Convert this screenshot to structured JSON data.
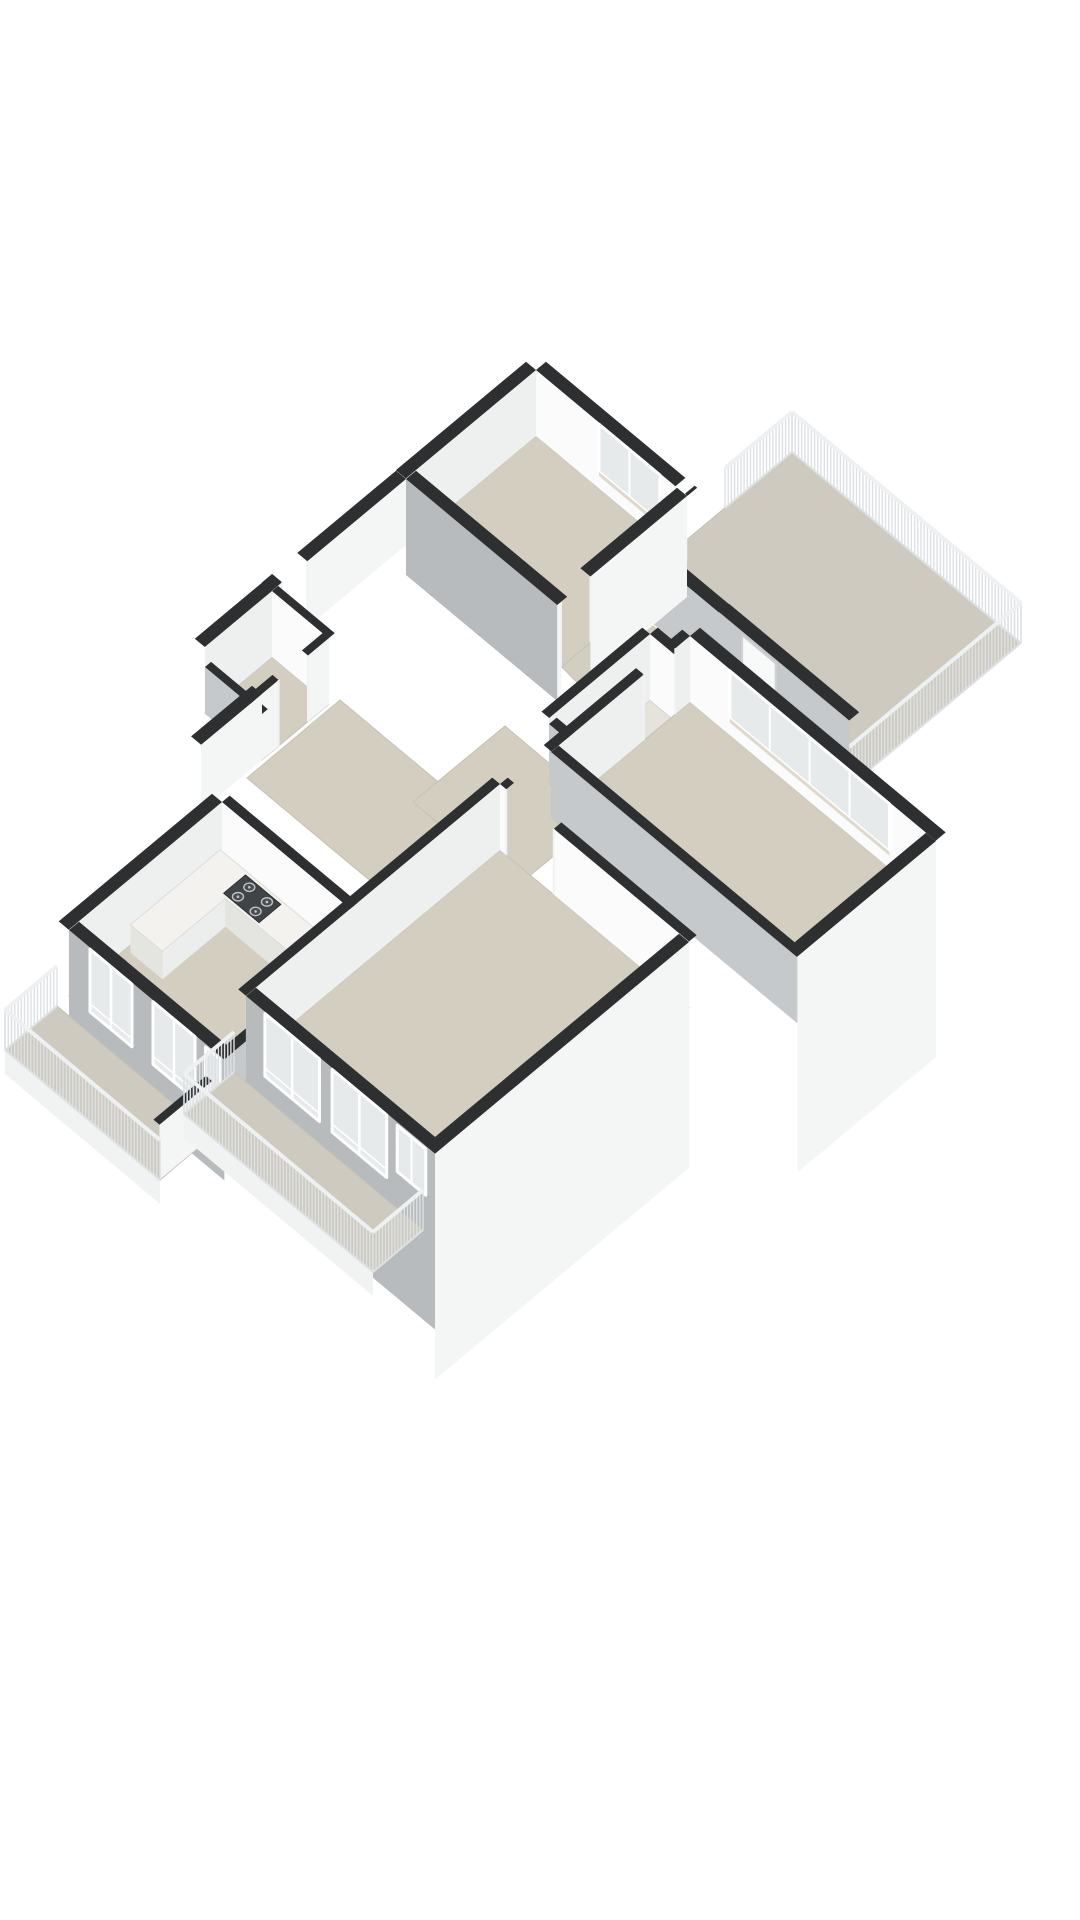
{
  "meta": {
    "title": "3D floor plan rendering",
    "background": "#ffffff",
    "render_style": "axonometric-cutaway",
    "rooms": [
      "bedroom-1",
      "bedroom-2",
      "living-room",
      "kitchen",
      "bathroom",
      "toilet",
      "hallway",
      "entry",
      "balcony-northeast",
      "balcony-southwest-kitchen",
      "balcony-southwest-living"
    ],
    "fixtures": [
      "kitchen-counter",
      "stove",
      "kitchen-sink",
      "bathtub"
    ],
    "features": [
      "slatted-balcony-railings",
      "french-doors",
      "window-bands",
      "door-openings",
      "cut-walls-dark-tops"
    ]
  },
  "palette": {
    "top": "#2d2f31",
    "white": "#fbfbfc",
    "faceSE": "#eef0f0",
    "bright": "#f4f5f5",
    "grayExt": "#b7bbbd",
    "grayInt": "#c6c9cb",
    "floor": "#d4cec1",
    "balcony": "#cecabf",
    "bath": "#e5e3dc",
    "glass": "#e7eaeb",
    "frame": "#ffffff",
    "sill": "#ded9cc",
    "jamb": "#f2f2f2",
    "slat": "#dde1e3",
    "railTop": "#eef0f1",
    "counterTop": "#f3f2ee",
    "counterFace": "#e4e4e1",
    "counterSide": "#eceded",
    "doorLeaf": "#f8f9f9",
    "doorFrame": "#cfd2d3",
    "handle": "#9aa0a3",
    "stove": "#404447",
    "burner": "#bfc4c6",
    "tubLine": "#d6d8d7",
    "tubIn": "#eeede8",
    "skirtFront": "#f1f2f2",
    "floorLine": "#c6c1b4"
  },
  "projection": {
    "e1": [
      42,
      35
    ],
    "e2": [
      -42,
      35
    ],
    "z_px": 33,
    "wall_h": 66,
    "rail_h": 40
  },
  "scene": [
    {
      "kind": "floor",
      "name": "balcony-northeast-floor",
      "o": [
        792,
        452
      ],
      "a": 5.45,
      "b": 4.1,
      "fill": "balcony"
    },
    {
      "kind": "rail",
      "name": "balcony-ne-railing-nw",
      "s": [
        792,
        452
      ],
      "e": [
        1021,
        643
      ]
    },
    {
      "kind": "rail",
      "name": "balcony-ne-railing-se",
      "s": [
        1021,
        643
      ],
      "e": [
        849,
        787
      ]
    },
    {
      "kind": "rail",
      "name": "balcony-ne-railing-sw",
      "s": [
        849,
        787
      ],
      "e": [
        719,
        678
      ]
    },
    {
      "kind": "rail",
      "name": "balcony-ne-railing-return",
      "s": [
        792,
        452
      ],
      "e": [
        725,
        508
      ]
    },
    {
      "kind": "floorAbs",
      "name": "hall-floor",
      "pts": [
        [
          559,
          664
        ],
        [
          630,
          607
        ],
        [
          762,
          717
        ],
        [
          684,
          793
        ]
      ],
      "fill": "floor"
    },
    {
      "kind": "wall",
      "name": "hall-balcony-wall",
      "s": [
        620,
        596
      ],
      "ax": "e1",
      "len": 2.36,
      "t": 13,
      "face": "grayInt",
      "h": 66
    },
    {
      "kind": "wall",
      "name": "balcony-door-wall",
      "s": [
        719,
        678
      ],
      "ax": "e1",
      "len": 3.1,
      "t": 13,
      "face": "grayInt",
      "h": 66,
      "doors": [
        [
          0.55,
          1.35
        ]
      ]
    },
    {
      "kind": "floor",
      "name": "bedroom-1-floor",
      "o": [
        536,
        436
      ],
      "a": 3.6,
      "b": 3.1,
      "fill": "floor"
    },
    {
      "kind": "wall",
      "name": "bedroom-1-wall-ne",
      "s": [
        536,
        436
      ],
      "ax": "e1",
      "len": 3.6,
      "t": 13,
      "face": "white",
      "h": 66,
      "gaps": [
        [
          3.32,
          3.54
        ]
      ],
      "win": [
        {
          "f": 1.5,
          "t": 2.95,
          "zb": 0.5,
          "zt": 1.95,
          "mull": 1,
          "sill": 1
        }
      ]
    },
    {
      "kind": "wall",
      "name": "bedroom-1-wall-nw",
      "s": [
        536,
        436
      ],
      "ax": "e2",
      "len": 3.1,
      "t": 13,
      "face": "faceSE",
      "h": 66
    },
    {
      "kind": "wall",
      "name": "bedroom-1-wall-se",
      "s": [
        687,
        562
      ],
      "ax": "e2",
      "len": 3.1,
      "t": 13,
      "face": "bright",
      "h": 66,
      "skirt": 35,
      "gaps": [
        [
          2.3,
          3.0
        ]
      ]
    },
    {
      "kind": "wall",
      "name": "bedroom-1-wall-sw",
      "s": [
        406,
        545
      ],
      "ax": "e1",
      "len": 3.6,
      "t": 13,
      "face": "grayExt",
      "h": 66,
      "skirt": 30
    },
    {
      "kind": "wall",
      "name": "hallway-west-wall",
      "s": [
        406,
        545
      ],
      "ax": "e2",
      "len": 3.2,
      "t": 13,
      "face": "bright",
      "h": 66,
      "gaps": [
        [
          2.35,
          2.95
        ]
      ]
    },
    {
      "kind": "floor",
      "name": "toilet-floor",
      "o": [
        272,
        657
      ],
      "a": 1.35,
      "b": 1.6,
      "fill": "floor"
    },
    {
      "kind": "wall",
      "name": "toilet-wall-ne",
      "s": [
        272,
        657
      ],
      "ax": "e1",
      "len": 1.35,
      "t": 8,
      "face": "white",
      "h": 66
    },
    {
      "kind": "wall",
      "name": "toilet-wall-nw",
      "s": [
        272,
        657
      ],
      "ax": "e2",
      "len": 1.6,
      "t": 13,
      "face": "faceSE",
      "h": 66
    },
    {
      "kind": "wall",
      "name": "toilet-wall-se",
      "s": [
        329,
        704
      ],
      "ax": "e2",
      "len": 1.6,
      "t": 8,
      "face": "bright",
      "h": 66,
      "gaps": [
        [
          0.5,
          1.2
        ]
      ]
    },
    {
      "kind": "wall",
      "name": "toilet-wall-sw",
      "s": [
        205,
        713
      ],
      "ax": "e1",
      "len": 1.35,
      "t": 8,
      "face": "grayInt",
      "h": 46
    },
    {
      "kind": "wall",
      "name": "entry-west-wall",
      "s": [
        262,
        760
      ],
      "ax": "e2",
      "len": 1.45,
      "t": 13,
      "face": "bright",
      "h": 66
    },
    {
      "kind": "floorAbs",
      "name": "corridor-floor",
      "pts": [
        [
          340,
          700
        ],
        [
          467,
          806
        ],
        [
          374,
          884
        ],
        [
          247,
          778
        ]
      ],
      "fill": "floor"
    },
    {
      "kind": "floorAbs",
      "name": "entry-floor",
      "pts": [
        [
          505,
          726
        ],
        [
          607,
          812
        ],
        [
          515,
          888
        ],
        [
          413,
          802
        ]
      ],
      "fill": "floor"
    },
    {
      "kind": "floor",
      "name": "bathroom-floor",
      "o": [
        650,
        700
      ],
      "a": 1.9,
      "b": 2.4,
      "fill": "bath"
    },
    {
      "kind": "wall",
      "name": "bathroom-wall-ne",
      "s": [
        650,
        700
      ],
      "ax": "e1",
      "len": 1.9,
      "t": 10,
      "face": "white",
      "h": 66,
      "gaps": [
        [
          1.3,
          1.85
        ]
      ]
    },
    {
      "kind": "wall",
      "name": "bathroom-wall-nw",
      "s": [
        650,
        700
      ],
      "ax": "e2",
      "len": 2.4,
      "t": 10,
      "face": "faceSE",
      "h": 66
    },
    {
      "kind": "tub",
      "name": "bathtub",
      "o": [
        650,
        700
      ],
      "r": [
        0.3,
        0.75,
        1.45,
        1.6
      ]
    },
    {
      "kind": "wall",
      "name": "bathroom-wall-se",
      "s": [
        730,
        767
      ],
      "ax": "e2",
      "len": 2.4,
      "t": 10,
      "face": "bright",
      "h": 66
    },
    {
      "kind": "wall",
      "name": "bathroom-wall-sw",
      "s": [
        549,
        784
      ],
      "ax": "e1",
      "len": 1.9,
      "t": 10,
      "face": "grayInt",
      "h": 60
    },
    {
      "kind": "floor",
      "name": "bedroom-2-floor",
      "o": [
        690,
        702
      ],
      "a": 5.85,
      "b": 3.3,
      "fill": "floor"
    },
    {
      "kind": "wall",
      "name": "bedroom-2-wall-ne",
      "s": [
        690,
        702
      ],
      "ax": "e1",
      "len": 5.85,
      "t": 13,
      "face": "white",
      "h": 66,
      "win": [
        {
          "f": 0.95,
          "t": 4.75,
          "zb": 0.5,
          "zt": 1.95,
          "mull": 3,
          "sill": 1
        }
      ]
    },
    {
      "kind": "wall",
      "name": "bedroom-2-wall-nw",
      "s": [
        690,
        702
      ],
      "ax": "e2",
      "len": 3.3,
      "t": 10,
      "face": "faceSE",
      "h": 66,
      "gaps": [
        [
          0.35,
          1.1
        ]
      ]
    },
    {
      "kind": "wall",
      "name": "bedroom-2-wall-se",
      "s": [
        936,
        907
      ],
      "ax": "e2",
      "len": 3.3,
      "t": 13,
      "face": "bright",
      "h": 66,
      "skirt": 150
    },
    {
      "kind": "wall",
      "name": "bedroom-2-wall-sw",
      "s": [
        551,
        818
      ],
      "ax": "e1",
      "len": 5.85,
      "t": 10,
      "face": "grayInt",
      "h": 66
    },
    {
      "kind": "floor",
      "name": "kitchen-floor",
      "o": [
        222,
        868
      ],
      "a": 3.7,
      "b": 3.65,
      "fill": "floor"
    },
    {
      "kind": "wall",
      "name": "kitchen-wall-ne",
      "s": [
        222,
        868
      ],
      "ax": "e1",
      "len": 3.7,
      "t": 10,
      "face": "white",
      "h": 66,
      "gaps": [
        [
          3.08,
          3.62
        ]
      ]
    },
    {
      "kind": "wall",
      "name": "kitchen-wall-nw",
      "s": [
        222,
        868
      ],
      "ax": "e2",
      "len": 3.65,
      "t": 13,
      "face": "faceSE",
      "h": 66
    },
    {
      "kind": "wall",
      "name": "kitchen-wall-se",
      "s": [
        377,
        998
      ],
      "ax": "e2",
      "len": 3.65,
      "t": 10,
      "face": "grayInt",
      "h": 66
    },
    {
      "kind": "wall",
      "name": "kitchen-facade-sw",
      "s": [
        69,
        996
      ],
      "ax": "e1",
      "len": 3.7,
      "t": 13,
      "face": "grayExt",
      "h": 66,
      "skirt": 55,
      "win": [
        {
          "f": 0.5,
          "t": 1.5,
          "zb": 0.05,
          "zt": 1.95,
          "mull": 1,
          "door": 1
        },
        {
          "f": 2.0,
          "t": 3.0,
          "zb": 0.05,
          "zt": 1.95,
          "mull": 1,
          "door": 1
        },
        {
          "f": 3.25,
          "t": 3.6,
          "zb": 0.75,
          "zt": 1.9,
          "mull": 0
        }
      ]
    },
    {
      "kind": "counter",
      "name": "kitchen-counter",
      "o": [
        222,
        868
      ],
      "h": 28,
      "pts": [
        [
          0.12,
          0.16
        ],
        [
          3.0,
          0.16
        ],
        [
          3.0,
          0.8
        ],
        [
          0.88,
          0.8
        ],
        [
          0.88,
          2.3
        ],
        [
          0.12,
          2.3
        ]
      ],
      "faces": [
        [
          1,
          2,
          "s"
        ],
        [
          2,
          3,
          "f"
        ],
        [
          3,
          4,
          "s"
        ],
        [
          4,
          5,
          "f"
        ]
      ]
    },
    {
      "kind": "stove",
      "name": "stove",
      "o": [
        222,
        868
      ],
      "h": 28,
      "r": [
        0.78,
        0.22,
        1.62,
        0.74
      ]
    },
    {
      "kind": "sink",
      "name": "kitchen-sink",
      "o": [
        222,
        868
      ],
      "h": 28,
      "r": [
        2.35,
        0.24,
        2.92,
        0.72
      ]
    },
    {
      "kind": "floor",
      "name": "living-room-floor",
      "o": [
        500,
        850
      ],
      "a": 4.5,
      "b": 6.05,
      "fill": "floor"
    },
    {
      "kind": "wall",
      "name": "living-room-wall-ne",
      "s": [
        500,
        850
      ],
      "ax": "e1",
      "len": 4.5,
      "t": 10,
      "face": "white",
      "h": 66,
      "gaps": [
        [
          0.15,
          1.28
        ]
      ]
    },
    {
      "kind": "wall",
      "name": "living-room-wall-nw",
      "s": [
        500,
        850
      ],
      "ax": "e2",
      "len": 6.05,
      "t": 10,
      "face": "faceSE",
      "h": 66
    },
    {
      "kind": "wall",
      "name": "living-room-wall-se",
      "s": [
        689,
        1008
      ],
      "ax": "e2",
      "len": 6.05,
      "t": 13,
      "face": "bright",
      "h": 66,
      "skirt": 160
    },
    {
      "kind": "wall",
      "name": "living-room-facade-sw",
      "s": [
        246,
        1062
      ],
      "ax": "e1",
      "len": 4.5,
      "t": 13,
      "face": "grayExt",
      "h": 66,
      "skirt": 110,
      "win": [
        {
          "f": 0.45,
          "t": 1.75,
          "zb": 0.05,
          "zt": 1.95,
          "mull": 1,
          "door": 1
        },
        {
          "f": 2.05,
          "t": 3.35,
          "zb": 0.05,
          "zt": 1.95,
          "mull": 1,
          "door": 1
        },
        {
          "f": 3.6,
          "t": 4.28,
          "zb": 0.5,
          "zt": 1.9,
          "mull": 1
        }
      ]
    },
    {
      "kind": "floorAbs",
      "name": "balcony-sw-kitchen-floor",
      "pts": [
        [
          57,
          1006
        ],
        [
          212,
          1136
        ],
        [
          160,
          1180
        ],
        [
          5,
          1050
        ]
      ],
      "fill": "balcony",
      "skirtEdge": [
        [
          5,
          1050
        ],
        [
          160,
          1180
        ]
      ]
    },
    {
      "kind": "wall",
      "name": "balcony-partition-wall",
      "s": [
        212,
        1136
      ],
      "ax": "e2",
      "len": 1.25,
      "t": 8,
      "face": "bright",
      "h": 55
    },
    {
      "kind": "rail",
      "name": "balcony-sw-k-railing-cap",
      "s": [
        57,
        1006
      ],
      "e": [
        5,
        1050
      ]
    },
    {
      "kind": "rail",
      "name": "balcony-sw-k-railing",
      "s": [
        5,
        1050
      ],
      "e": [
        160,
        1180
      ]
    },
    {
      "kind": "floorAbs",
      "name": "balcony-sw-living-floor",
      "pts": [
        [
          234,
          1072
        ],
        [
          423,
          1230
        ],
        [
          373,
          1272
        ],
        [
          184,
          1114
        ]
      ],
      "fill": "balcony",
      "skirtEdge": [
        [
          184,
          1114
        ],
        [
          373,
          1272
        ]
      ]
    },
    {
      "kind": "rail",
      "name": "balcony-sw-l-railing-cap",
      "s": [
        234,
        1072
      ],
      "e": [
        184,
        1114
      ]
    },
    {
      "kind": "rail",
      "name": "balcony-sw-l-railing",
      "s": [
        184,
        1114
      ],
      "e": [
        373,
        1272
      ]
    },
    {
      "kind": "rail",
      "name": "balcony-sw-l-railing-end",
      "s": [
        423,
        1230
      ],
      "e": [
        373,
        1272
      ]
    }
  ]
}
